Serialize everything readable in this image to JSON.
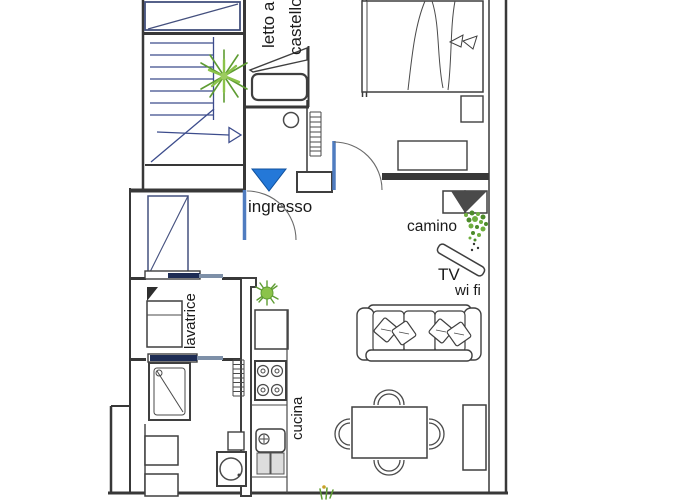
{
  "plan": {
    "type": "apartment-floor-plan",
    "labels": {
      "bunk_bed_line1": "letto a",
      "bunk_bed_line2": "castello",
      "entrance": "ingresso",
      "fireplace": "camino",
      "tv": "TV",
      "wifi": "wi fi",
      "washing_machine": "lavatrice",
      "kitchen": "cucina"
    },
    "colors": {
      "entrance_arrow_blue": "#2478d8",
      "door_leaf_blue": "#4f7cc0",
      "stair_line_blue": "#3c4c8c",
      "plant_green": "#6fae3e",
      "fireplace_dark": "#4a4a4a",
      "wall_dark": "#383838",
      "sliding_door_navy": "#1d2c54",
      "sliding_door_gray": "#7e90a8"
    }
  }
}
